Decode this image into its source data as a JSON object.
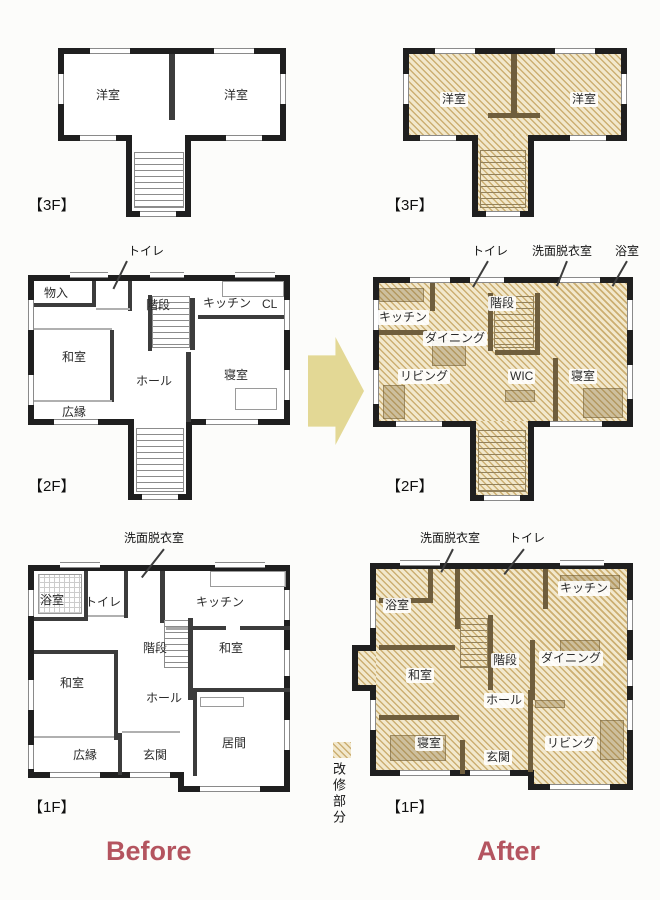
{
  "captions": {
    "before": "Before",
    "after": "After"
  },
  "legend": {
    "label": "改修部分"
  },
  "colors": {
    "renovation_hatch": "#ccaf72",
    "arrow": "#e3d895",
    "caption_red": "#b4545f",
    "wall": "#1f1f1f"
  },
  "plans": {
    "f3_before": {
      "floor_label": "【3F】",
      "rooms": [
        {
          "label": "洋室"
        },
        {
          "label": "洋室"
        }
      ],
      "callouts": []
    },
    "f3_after": {
      "floor_label": "【3F】",
      "rooms": [
        {
          "label": "洋室"
        },
        {
          "label": "洋室"
        }
      ],
      "callouts": []
    },
    "f2_before": {
      "floor_label": "【2F】",
      "rooms": [
        {
          "label": "物入"
        },
        {
          "label": "階段"
        },
        {
          "label": "キッチン"
        },
        {
          "label": "CL"
        },
        {
          "label": "和室"
        },
        {
          "label": "ホール"
        },
        {
          "label": "寝室"
        },
        {
          "label": "広縁"
        }
      ],
      "callouts": [
        {
          "label": "トイレ"
        }
      ]
    },
    "f2_after": {
      "floor_label": "【2F】",
      "rooms": [
        {
          "label": "キッチン"
        },
        {
          "label": "階段"
        },
        {
          "label": "ダイニング"
        },
        {
          "label": "リビング"
        },
        {
          "label": "WIC"
        },
        {
          "label": "寝室"
        }
      ],
      "callouts": [
        {
          "label": "トイレ"
        },
        {
          "label": "洗面脱衣室"
        },
        {
          "label": "浴室"
        }
      ]
    },
    "f1_before": {
      "floor_label": "【1F】",
      "rooms": [
        {
          "label": "浴室"
        },
        {
          "label": "トイレ"
        },
        {
          "label": "キッチン"
        },
        {
          "label": "階段"
        },
        {
          "label": "和室"
        },
        {
          "label": "和室"
        },
        {
          "label": "ホール"
        },
        {
          "label": "広縁"
        },
        {
          "label": "玄関"
        },
        {
          "label": "居間"
        }
      ],
      "callouts": [
        {
          "label": "洗面脱衣室"
        }
      ]
    },
    "f1_after": {
      "floor_label": "【1F】",
      "rooms": [
        {
          "label": "浴室"
        },
        {
          "label": "キッチン"
        },
        {
          "label": "和室"
        },
        {
          "label": "階段"
        },
        {
          "label": "ダイニング"
        },
        {
          "label": "ホール"
        },
        {
          "label": "寝室"
        },
        {
          "label": "玄関"
        },
        {
          "label": "リビング"
        }
      ],
      "callouts": [
        {
          "label": "洗面脱衣室"
        },
        {
          "label": "トイレ"
        }
      ]
    }
  }
}
